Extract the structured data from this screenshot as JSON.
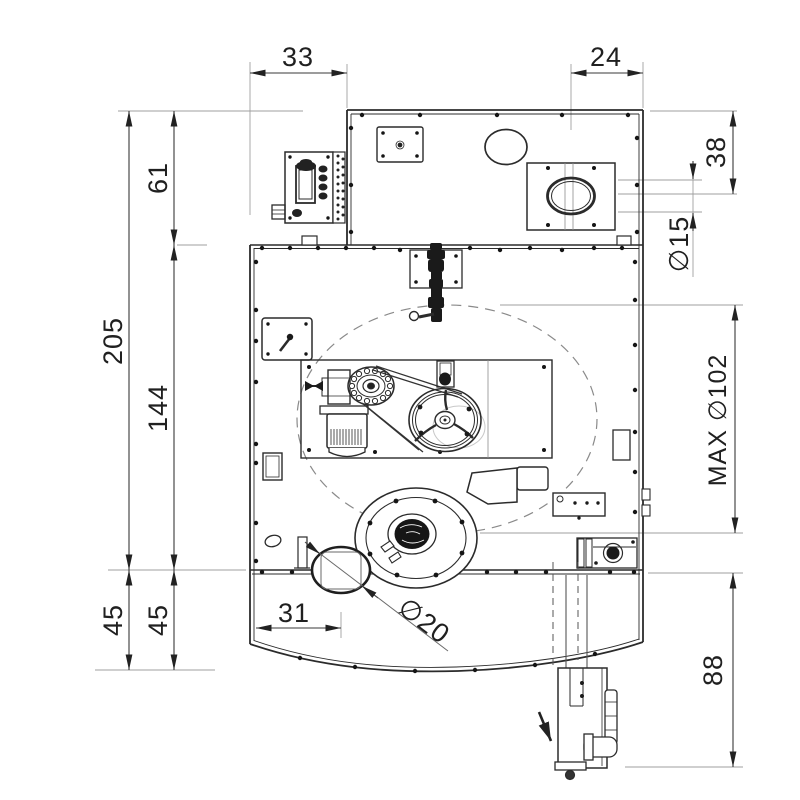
{
  "drawing": {
    "dimensions": {
      "top_offset_left": "33",
      "top_offset_right": "24",
      "upper_height": "61",
      "total_height": "205",
      "body_height": "144",
      "lower_height_outer": "45",
      "lower_height_inner": "45",
      "spout_offset": "38",
      "spout_diameter": "∅15",
      "max_diameter": "MAX ∅102",
      "drain_offset": "31",
      "drain_diameter": "∅20",
      "drain_depth": "88"
    },
    "colors": {
      "line": "#2b2b2b",
      "dimension": "#3a3a3a",
      "extension": "#9f9f9f",
      "dashed_reference": "#8a8a8a",
      "background": "#ffffff"
    }
  }
}
